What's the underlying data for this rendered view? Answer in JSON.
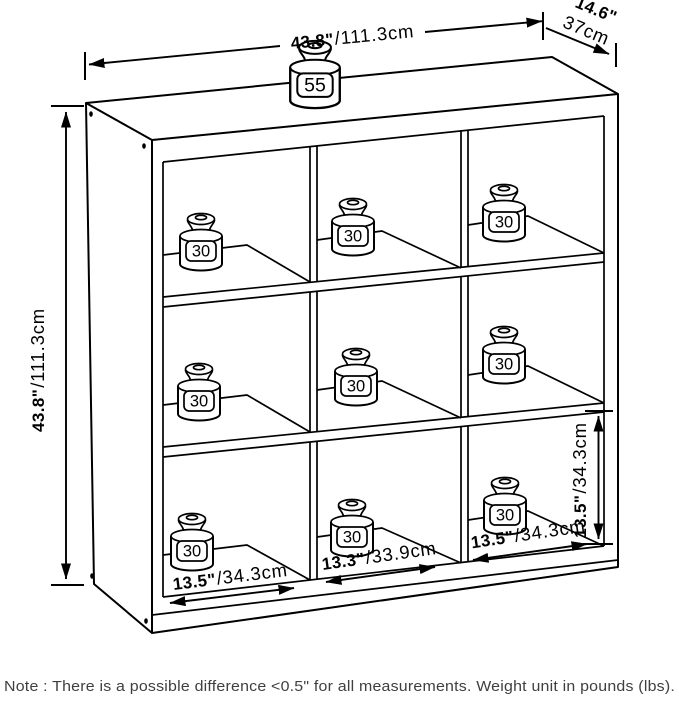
{
  "title": "9-cube storage organizer dimension diagram",
  "colors": {
    "line": "#000000",
    "note_text": "#3f3f3f",
    "background": "#ffffff"
  },
  "dimensions": {
    "width": {
      "inches": "43.8\"",
      "cm": "/111.3cm"
    },
    "depth": {
      "inches": "14.6\"",
      "cm": "37cm"
    },
    "height": {
      "inches": "43.8\"",
      "cm": "/111.3cm"
    },
    "cube_height": {
      "inches": "13.5\"",
      "cm": "/34.3cm"
    },
    "cube_widths": [
      {
        "inches": "13.5\"",
        "cm": "/34.3cm"
      },
      {
        "inches": "13.3\"",
        "cm": "/33.9cm"
      },
      {
        "inches": "13.5\"",
        "cm": "/34.3cm"
      }
    ]
  },
  "weights": {
    "top": {
      "label": "55"
    },
    "cubes": [
      {
        "label": "30"
      },
      {
        "label": "30"
      },
      {
        "label": "30"
      },
      {
        "label": "30"
      },
      {
        "label": "30"
      },
      {
        "label": "30"
      },
      {
        "label": "30"
      },
      {
        "label": "30"
      },
      {
        "label": "30"
      }
    ]
  },
  "note": {
    "text": "Note : There is a possible difference <0.5\" for all measurements. Weight unit in pounds (lbs)."
  }
}
